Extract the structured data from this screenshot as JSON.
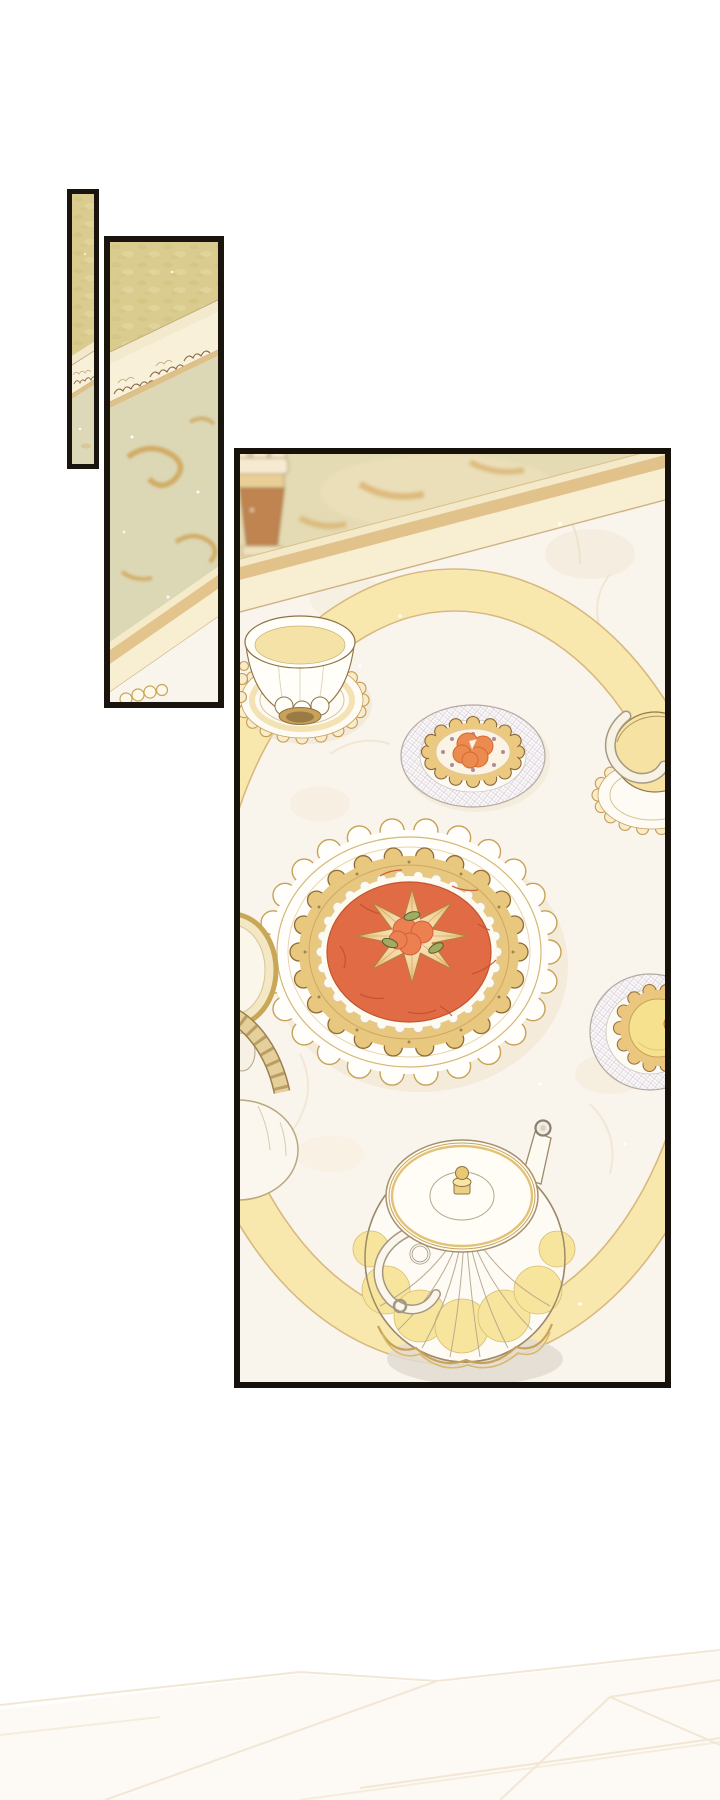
{
  "page": {
    "background": "#ffffff",
    "type": "comic-page"
  },
  "panels": {
    "sliver": {
      "label": "narrow panel: gilded wall and carved molding"
    },
    "column": {
      "label": "tall panel: wall, carved molding, ornate floor and marble table edge"
    },
    "main": {
      "label": "main panel: marble tea table set with desserts and teapot"
    }
  },
  "objects": {
    "goblet": "blurred bronze goblet on patterned floor",
    "table_edge": "cream and tan table edge band",
    "tray_ring": "large oval gilded tray rim on marble",
    "teacup_left": "white fluted teacup on gold scalloped saucer",
    "apricot_tartlet": "apricot cream tartlet on lattice-rimmed plate",
    "grand_tart": "grand apricot tart with sliced-fruit star on scalloped gold doily",
    "teacup_right": "cream teacup on scalloped saucer, cropped by border",
    "lemon_tartlet": "lemon tartlet on lattice-rimmed plate, cropped by border",
    "gilded_vessel": "gilded checker-banded vessel, cropped by border",
    "teapot": "fluted porcelain teapot with gold knob and ornate handle",
    "fade_sketch": "faint unfinished lineart at page bottom"
  },
  "palette": {
    "panel_border": "#1a140e",
    "wall_gold": "#d9cc8e",
    "wall_gold_dark": "#cfc07b",
    "molding_cream": "#f3e9cd",
    "molding_leaf_fill": "#f8f0d8",
    "molding_leaf_outline": "#8a6a43",
    "floor_sage": "#dcd7b5",
    "floor_ornament_gold": "#d0a95e",
    "marble_white": "#f9f4ec",
    "marble_vein": "#ead8ba",
    "band_cream": "#f8efd2",
    "band_tan": "#e2c28b",
    "tray_ring_yellow": "#f9e8ae",
    "tray_ring_edge": "#d8b97b",
    "porcelain_white": "#fffef9",
    "porcelain_outline": "#8d7345",
    "gold_trim": "#c49a55",
    "tea_cream": "#f4e2a6",
    "crust_gold": "#e8c77f",
    "cream_filling": "#fdfaf1",
    "tart_filling_orange": "#e06b45",
    "tart_crack": "#c2512e",
    "fruit_orange": "#ec8b50",
    "star_fruit_peach": "#f3d6a2",
    "leaf_green": "#a3ab60",
    "lemon_yellow": "#f6e28e",
    "lattice_grey": "#d9d1db",
    "teapot_petal_yellow": "#f8e59d",
    "shadow_grey": "#e3dad2",
    "fade_line": "#f1e7d4"
  }
}
